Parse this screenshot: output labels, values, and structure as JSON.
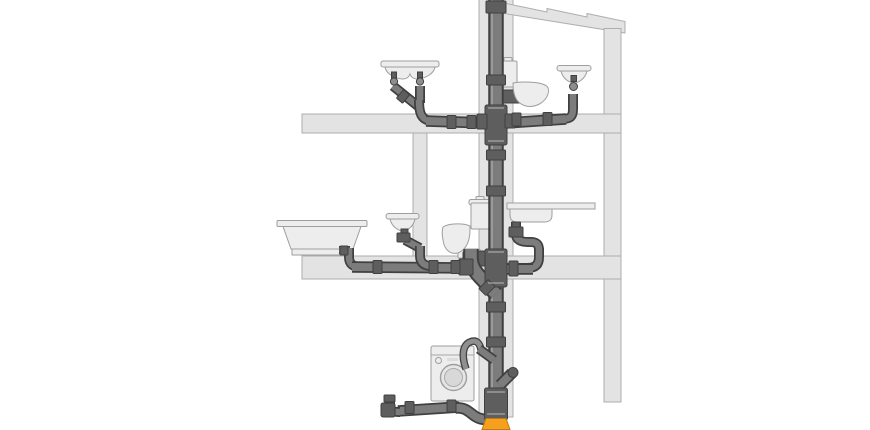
{
  "meta": {
    "title": "Building drainage system cutaway diagram",
    "description": "Sectional illustration of a three-level house drainage installation: a vertical soil stack with branch connections to sanitary fixtures on each floor, venting through the roof and discharging into an underground adapter at the base.",
    "text_content": "none — purely pictorial diagram, no visible text labels"
  },
  "colors": {
    "background": "#FFFFFF",
    "structure_fill": "#E3E3E3",
    "structure_outline": "#AEAEAE",
    "fixture_fill": "#EDEDED",
    "fixture_outline": "#9E9E9E",
    "pipe_body": "#7C7C7C",
    "pipe_outline": "#404040",
    "fitting_fill": "#5E5E5E",
    "pipe_highlight": "#BDBDBD",
    "hose_body": "#8F8F8F",
    "base_adapter_orange": "#F5A01E",
    "base_adapter_outline": "#C07C0E"
  },
  "components": {
    "stack": "soil-stack-with-roof-vent",
    "structure": [
      "stepped-roof",
      "right-exterior-wall",
      "pipe-chase-wall",
      "upper-floor-slab",
      "middle-floor-slab",
      "partition-wall"
    ],
    "floors": [
      {
        "name": "upper-floor",
        "fixtures": [
          "double-washbasin-with-twin-traps",
          "toilet-with-cistern",
          "wall-hung-washbasin"
        ]
      },
      {
        "name": "middle-floor",
        "fixtures": [
          "bathtub-with-trap",
          "wall-hung-washbasin",
          "toilet-with-cistern",
          "kitchen-sink-with-bottle-trap"
        ]
      },
      {
        "name": "ground-floor",
        "fixtures": [
          "washing-machine-with-drain-hose",
          "spare-branch-connection",
          "horizontal-drain-line-with-access-end"
        ]
      }
    ],
    "base": "orange-underground-transition-adapter"
  }
}
